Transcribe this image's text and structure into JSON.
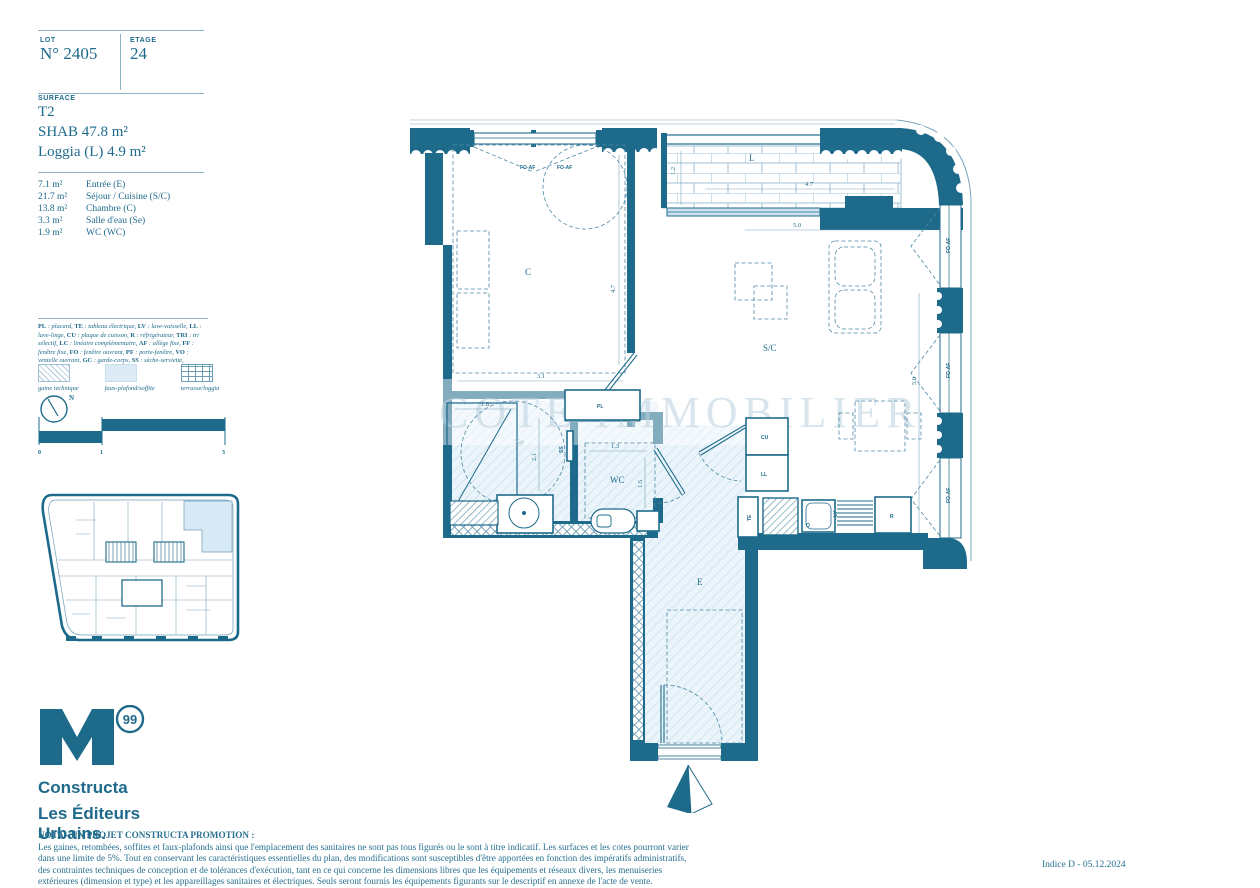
{
  "header": {
    "lot_label": "LOT",
    "lot_value": "N° 2405",
    "etage_label": "ETAGE",
    "etage_value": "24"
  },
  "surface": {
    "label": "SURFACE",
    "type": "T2",
    "shab": "SHAB 47.8 m²",
    "loggia": "Loggia (L) 4.9 m²"
  },
  "rooms": [
    {
      "area": "7.1 m²",
      "name": "Entrée (E)"
    },
    {
      "area": "21.7 m²",
      "name": "Séjour / Cuisine (S/C)"
    },
    {
      "area": "13.8 m²",
      "name": "Chambre (C)"
    },
    {
      "area": "3.3 m²",
      "name": "Salle d'eau (Se)"
    },
    {
      "area": "1.9 m²",
      "name": "WC (WC)"
    }
  ],
  "legend": {
    "items": [
      {
        "k": "PL",
        "v": "placard"
      },
      {
        "k": "TE",
        "v": "tableau électrique"
      },
      {
        "k": "LV",
        "v": "lave-vaisselle"
      },
      {
        "k": "LL",
        "v": "lave-linge"
      },
      {
        "k": "CU",
        "v": "plaque de cuisson"
      },
      {
        "k": "R",
        "v": "réfrigérateur"
      },
      {
        "k": "TRI",
        "v": "tri sélectif"
      },
      {
        "k": "LC",
        "v": "linéaire complémentaire"
      },
      {
        "k": "AF",
        "v": "allège fixe"
      },
      {
        "k": "FF",
        "v": "fenêtre fixe"
      },
      {
        "k": "FO",
        "v": "fenêtre ouvrant"
      },
      {
        "k": "PF",
        "v": "porte-fenêtre"
      },
      {
        "k": "VO",
        "v": "ventelle ouvrant"
      },
      {
        "k": "GC",
        "v": "garde-corps"
      },
      {
        "k": "SS",
        "v": "sèche-serviette"
      }
    ],
    "swatches": [
      {
        "label": "gaine technique"
      },
      {
        "label": "faux-plafond/soffite"
      },
      {
        "label": "terrasse/loggia"
      }
    ]
  },
  "compass": {
    "north": "N"
  },
  "scale": {
    "t0": "0",
    "t1": "1",
    "t3": "3"
  },
  "logo": {
    "badge": "99",
    "line1": "Constructa",
    "line2": "Les Éditeurs",
    "line3": "Urbains."
  },
  "nota": {
    "title": "NOTA - UN PROJET CONSTRUCTA PROMOTION :",
    "body": "Les gaines, retombées, soffites et faux-plafonds ainsi que l'emplacement des sanitaires ne sont pas tous figurés ou le sont à titre indicatif. Les surfaces et les cotes pourront varier dans une limite de 5%. Tout en conservant les caractéristiques essentielles du plan, des modifications sont susceptibles d'être apportées en fonction des impératifs administratifs, des contraintes techniques de conception et de tolérances d'exécution, tant en ce qui concerne les dimensions libres que les équipements et réseaux divers, les menuiseries extérieures (dimension et type) et les appareillages sanitaires et électriques. Seuls seront fournis les équipements figurants sur le descriptif en annexe de l'acte de vente."
  },
  "footer": {
    "indice": "Indice D - 05.12.2024"
  },
  "plan": {
    "rooms": {
      "bedroom": "C",
      "living": "S/C",
      "bath": "Se",
      "wc": "WC",
      "entry": "E",
      "loggia": "L"
    },
    "fixtures": {
      "pl": "PL",
      "cu": "CU",
      "ll": "LL",
      "te": "TE",
      "lv": "LV",
      "r": "R",
      "o": "O",
      "ss": "SS"
    },
    "windows": {
      "foaf": "FO-AF"
    },
    "dims": {
      "bed_w": "3.1",
      "bed_h": "4.7",
      "loggia_w": "4.7",
      "loggia_h": "1.2",
      "living_w": "5.0",
      "living_h": "5.0",
      "shower": "1.8",
      "bath_h": "2.1",
      "wc_w": "1.3",
      "wc_h": "1.5"
    },
    "watermark": "COTE IMMOBILIER"
  },
  "colors": {
    "teal": "#1E6A8B",
    "light": "#E9F3FA",
    "accent": "#4F88A6"
  }
}
